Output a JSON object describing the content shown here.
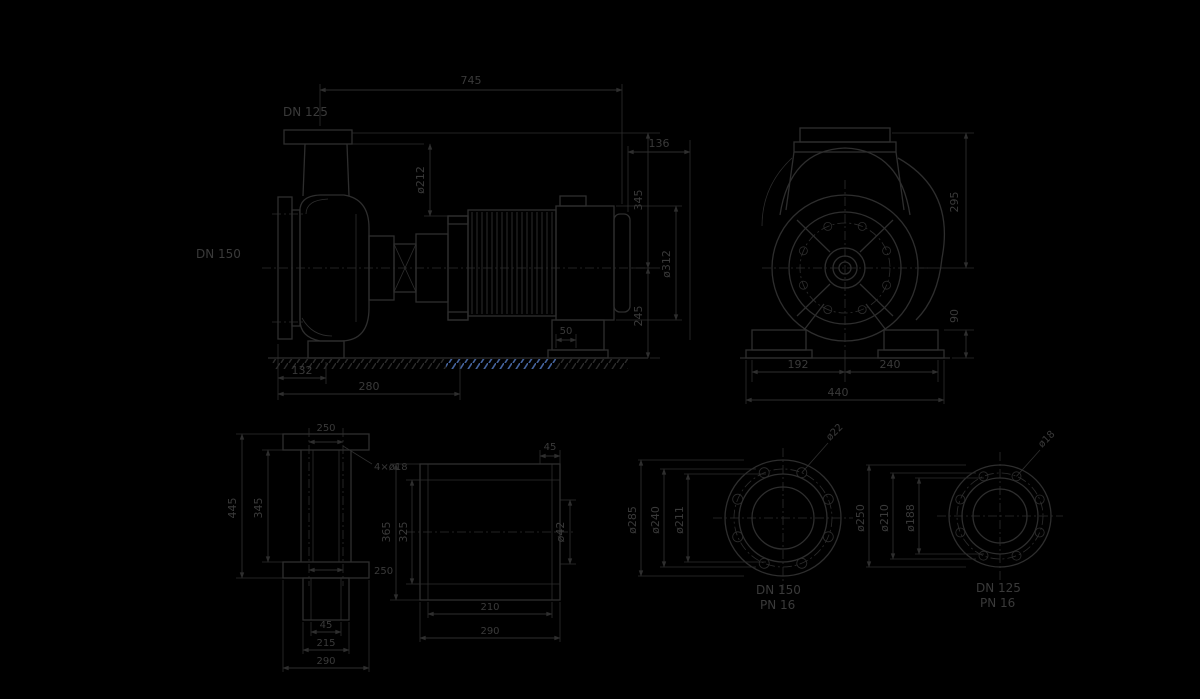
{
  "drawing": {
    "background": "#000000",
    "line_color": "#2e2e2e",
    "text_color": "#3a3a3a",
    "hatch_blue": "#44639e",
    "main_view": {
      "discharge_flange": "DN 125",
      "suction_flange": "DN 150",
      "overall_length": "745",
      "motor_rear_clearance": "136",
      "lantern_diameter": "ø212",
      "axis_to_flange_height": "345",
      "axis_to_base_height": "245",
      "motor_diameter": "ø312",
      "motor_foot_width": "50",
      "foot_offset": "132",
      "foot_span": "280"
    },
    "end_view": {
      "axis_to_top": "295",
      "foot_height": "90",
      "left_foot_span": "192",
      "right_foot_span": "240",
      "overall_width": "440"
    },
    "support_view": {
      "bolt_span_top": "250",
      "bolt_note": "4×ø18",
      "inner_height": "345",
      "overall_height": "445",
      "bolt_span_bottom": "250",
      "stub_width": "45",
      "stub_span": "215",
      "base_width": "290"
    },
    "bracket_view": {
      "corner_offset": "45",
      "shaft_diameter": "ø42",
      "inner_height": "325",
      "overall_height": "365",
      "hole_span": "210",
      "overall_width": "290"
    },
    "flange_views": [
      {
        "outer_diameter": "ø285",
        "bolt_circle": "ø240",
        "face_diameter": "ø211",
        "hole_note": "ø22",
        "size": "DN 150",
        "pressure": "PN 16"
      },
      {
        "outer_diameter": "ø250",
        "bolt_circle": "ø210",
        "face_diameter": "ø188",
        "hole_note": "ø18",
        "size": "DN 125",
        "pressure": "PN 16"
      }
    ]
  }
}
